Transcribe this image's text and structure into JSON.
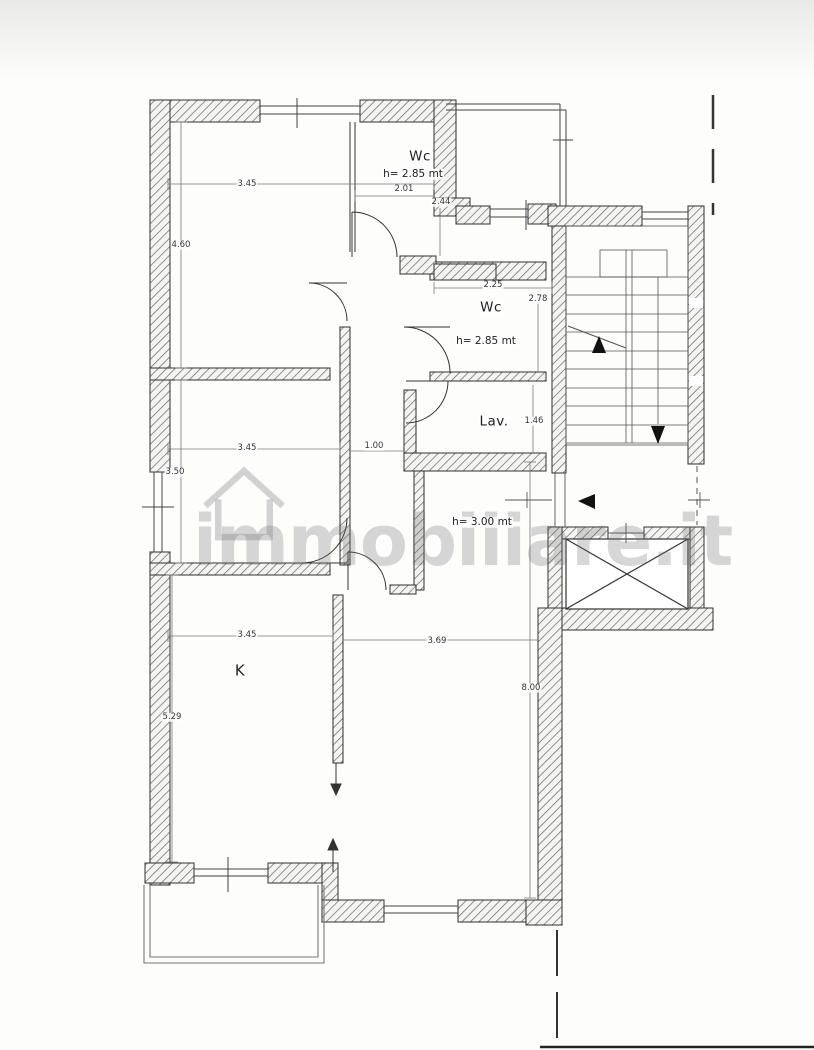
{
  "watermark": {
    "text": "immobiliare.it"
  },
  "rooms": [
    {
      "name": "wc-top",
      "label": "Wc",
      "height_label": "h= 2.85 mt"
    },
    {
      "name": "wc-middle",
      "label": "Wc",
      "height_label": "h= 2.85 mt"
    },
    {
      "name": "laundry",
      "label": "Lav."
    },
    {
      "name": "hallway",
      "height_label": "h= 3.00 mt"
    },
    {
      "name": "kitchen",
      "label": "K"
    }
  ],
  "dimensions": [
    "3.45",
    "4.60",
    "2.01",
    "2.44",
    "2.25",
    "2.78",
    "3.45",
    "1.00",
    "3.50",
    "1.46",
    "3.45",
    "3.69",
    "5.29",
    "8.00"
  ],
  "icons": {
    "stairs_up_arrow": "▲",
    "stairs_down_arrow": "▼",
    "entrance_arrow": "◀",
    "passage_up_arrow": "↑",
    "passage_down_arrow": "↓",
    "watermark_house": "⌂"
  },
  "colors": {
    "wall_hatch": "#6f6f6f",
    "wall_outline": "#2f2f2f",
    "thin_line": "#555555",
    "dimension_text": "#333333",
    "watermark_gray": "#707070",
    "paper": "#fdfdfc"
  }
}
